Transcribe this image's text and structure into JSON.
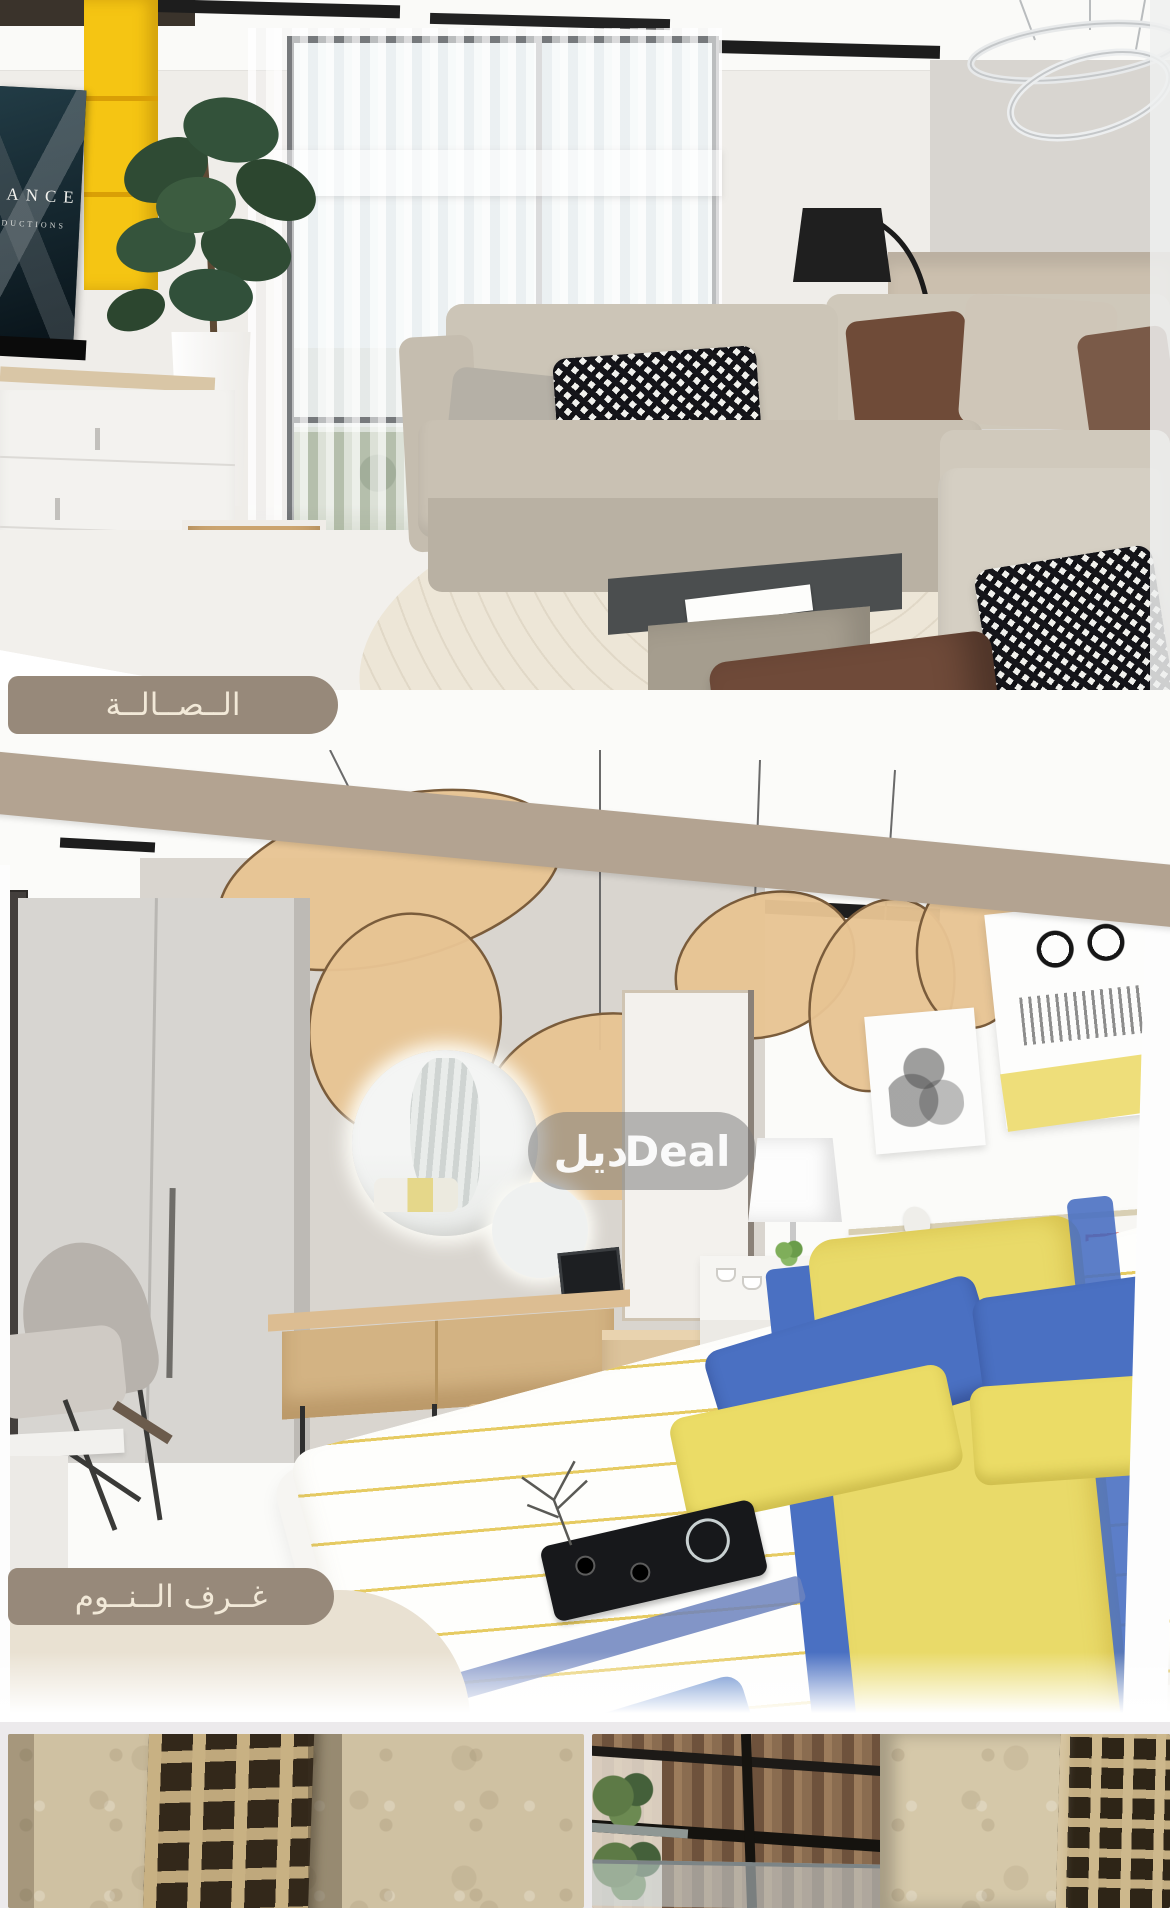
{
  "meta": {
    "width": 1170,
    "height": 1908,
    "description_hint": "real estate listing collage: living room render, bedroom render, exterior facade strip"
  },
  "labels": {
    "living_room": "الــصــالــة",
    "bedrooms": "غــرف الــنــوم"
  },
  "watermark": {
    "arabic": "ديل",
    "latin": "Deal"
  },
  "tv": {
    "line1": "DANCE",
    "line2": "PRODUCTIONS"
  },
  "colors": {
    "label_pill": "#97897a",
    "label_text": "#f2e9d8",
    "divider_band": "#b3a391",
    "accent_yellow": "#f5c513",
    "pillow_blue": "#4a70c2",
    "pillow_yellow": "#ebdc66",
    "ottoman_brown": "#6f4a39",
    "stone_beige": "#cfc1a2",
    "watermark_bg": "rgba(122,122,122,0.52)",
    "tv_bg": "#0f1d26"
  }
}
